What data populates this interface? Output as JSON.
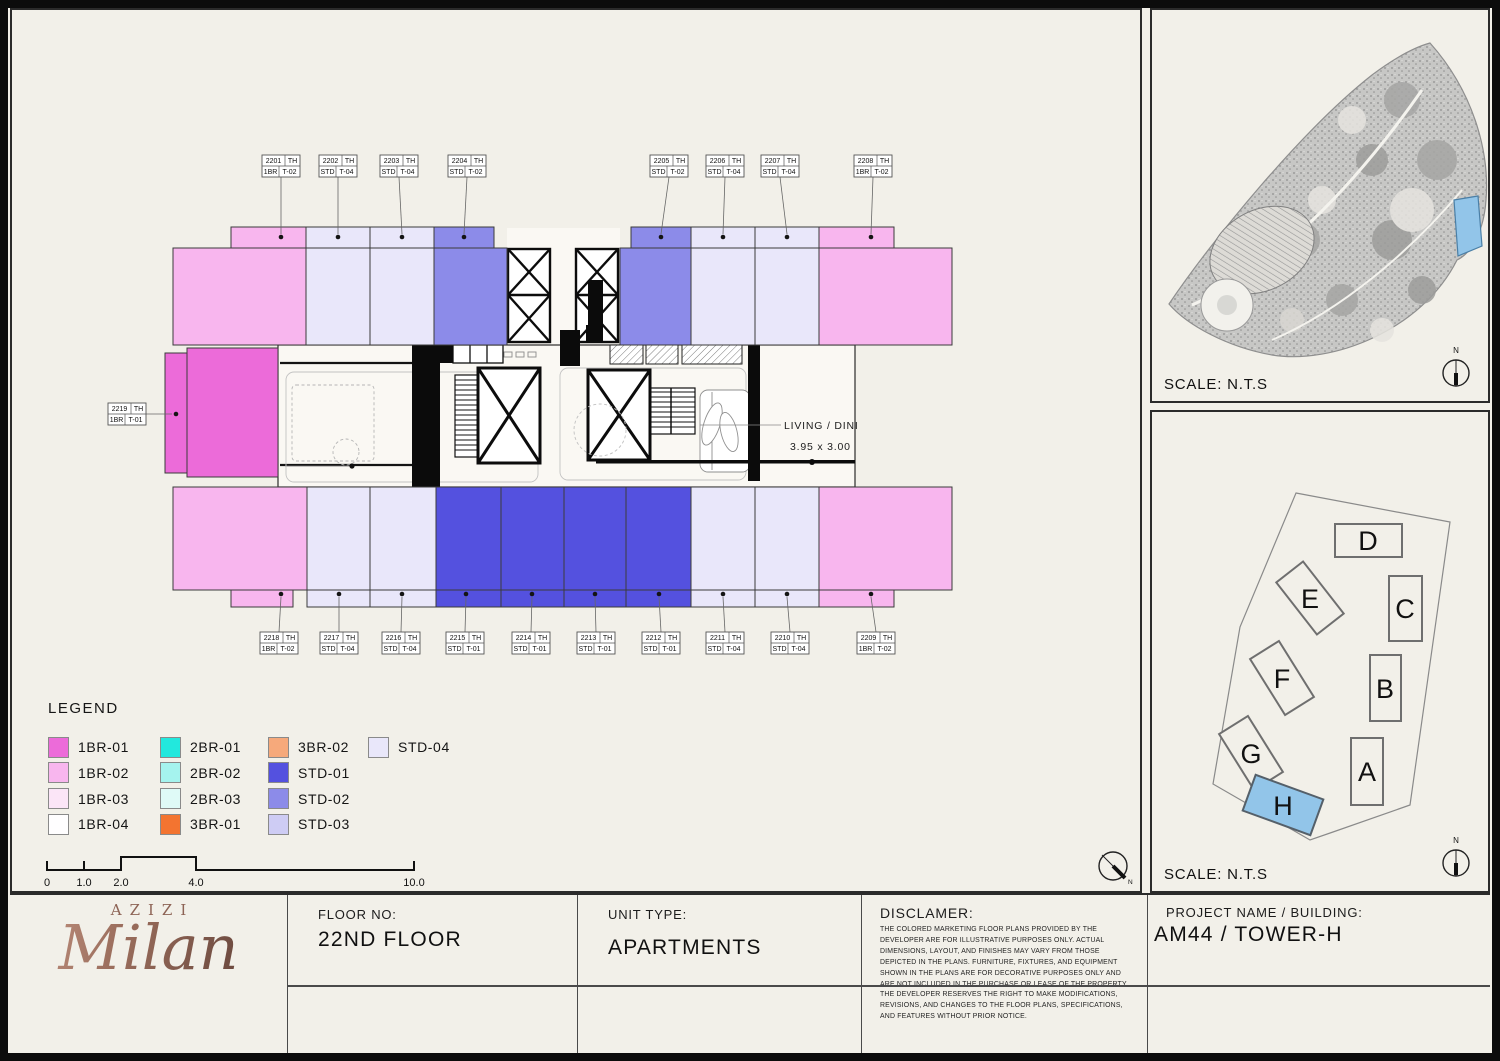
{
  "floor_plan": {
    "units_top": [
      {
        "no": "2201",
        "th": "TH",
        "cat": "1BR",
        "code": "T-02",
        "type": "1BR-02"
      },
      {
        "no": "2202",
        "th": "TH",
        "cat": "STD",
        "code": "T-04",
        "type": "STD-04"
      },
      {
        "no": "2203",
        "th": "TH",
        "cat": "STD",
        "code": "T-04",
        "type": "STD-04"
      },
      {
        "no": "2204",
        "th": "TH",
        "cat": "STD",
        "code": "T-02",
        "type": "STD-02"
      },
      {
        "no": "2205",
        "th": "TH",
        "cat": "STD",
        "code": "T-02",
        "type": "STD-02"
      },
      {
        "no": "2206",
        "th": "TH",
        "cat": "STD",
        "code": "T-04",
        "type": "STD-04"
      },
      {
        "no": "2207",
        "th": "TH",
        "cat": "STD",
        "code": "T-04",
        "type": "STD-04"
      },
      {
        "no": "2208",
        "th": "TH",
        "cat": "1BR",
        "code": "T-02",
        "type": "1BR-02"
      }
    ],
    "units_bottom": [
      {
        "no": "2218",
        "th": "TH",
        "cat": "1BR",
        "code": "T-02",
        "type": "1BR-02"
      },
      {
        "no": "2217",
        "th": "TH",
        "cat": "STD",
        "code": "T-04",
        "type": "STD-04"
      },
      {
        "no": "2216",
        "th": "TH",
        "cat": "STD",
        "code": "T-04",
        "type": "STD-04"
      },
      {
        "no": "2215",
        "th": "TH",
        "cat": "STD",
        "code": "T-01",
        "type": "STD-01"
      },
      {
        "no": "2214",
        "th": "TH",
        "cat": "STD",
        "code": "T-01",
        "type": "STD-01"
      },
      {
        "no": "2213",
        "th": "TH",
        "cat": "STD",
        "code": "T-01",
        "type": "STD-01"
      },
      {
        "no": "2212",
        "th": "TH",
        "cat": "STD",
        "code": "T-01",
        "type": "STD-01"
      },
      {
        "no": "2211",
        "th": "TH",
        "cat": "STD",
        "code": "T-04",
        "type": "STD-04"
      },
      {
        "no": "2210",
        "th": "TH",
        "cat": "STD",
        "code": "T-04",
        "type": "STD-04"
      },
      {
        "no": "2209",
        "th": "TH",
        "cat": "1BR",
        "code": "T-02",
        "type": "1BR-02"
      }
    ],
    "unit_left": {
      "no": "2219",
      "th": "TH",
      "cat": "1BR",
      "code": "T-01",
      "type": "1BR-01"
    },
    "room_label": {
      "name": "LIVING / DINING",
      "dims": "3.95 x 3.00"
    }
  },
  "legend": {
    "title": "LEGEND",
    "items": [
      {
        "label": "1BR-01",
        "color": "#EC6BD9"
      },
      {
        "label": "1BR-02",
        "color": "#F8B6EE"
      },
      {
        "label": "1BR-03",
        "color": "#FBE5F7"
      },
      {
        "label": "1BR-04",
        "color": "#FFFEFF"
      },
      {
        "label": "2BR-01",
        "color": "#22E8DD"
      },
      {
        "label": "2BR-02",
        "color": "#A5F3EE"
      },
      {
        "label": "2BR-03",
        "color": "#DFFAF7"
      },
      {
        "label": "3BR-01",
        "color": "#F37430"
      },
      {
        "label": "3BR-02",
        "color": "#F6A97B"
      },
      {
        "label": "STD-01",
        "color": "#5451DF"
      },
      {
        "label": "STD-02",
        "color": "#8C8BE9"
      },
      {
        "label": "STD-03",
        "color": "#CECCF4"
      },
      {
        "label": "STD-04",
        "color": "#E9E7FA"
      }
    ]
  },
  "scale_bar": {
    "labels": [
      "0",
      "1.0",
      "2.0",
      "4.0",
      "10.0"
    ]
  },
  "site_panel": {
    "scale_label": "SCALE: N.T.S",
    "north_label": "N",
    "highlight_color": "#92C5E9"
  },
  "key_panel": {
    "scale_label": "SCALE: N.T.S",
    "north_label": "N",
    "buildings": [
      "D",
      "E",
      "C",
      "F",
      "B",
      "G",
      "A",
      "H"
    ],
    "highlighted": "H",
    "highlight_color": "#92C5E9"
  },
  "title_block": {
    "logo": {
      "brand": "AZIZI",
      "name": "Milan"
    },
    "floor": {
      "label": "FLOOR NO:",
      "value": "22ND FLOOR"
    },
    "unit_type": {
      "label": "UNIT TYPE:",
      "value": "APARTMENTS"
    },
    "disclaimer": {
      "label": "DISCLAMER:",
      "text": "THE COLORED MARKETING FLOOR PLANS PROVIDED BY THE DEVELOPER ARE FOR ILLUSTRATIVE PURPOSES ONLY. ACTUAL DIMENSIONS, LAYOUT, AND FINISHES MAY VARY FROM THOSE DEPICTED IN THE PLANS. FURNITURE, FIXTURES, AND EQUIPMENT SHOWN IN THE PLANS ARE FOR DECORATIVE PURPOSES ONLY AND ARE NOT INCLUDED IN THE PURCHASE OR LEASE OF THE PROPERTY. THE DEVELOPER RESERVES THE RIGHT TO MAKE MODIFICATIONS, REVISIONS, AND CHANGES TO THE FLOOR PLANS, SPECIFICATIONS, AND FEATURES WITHOUT PRIOR NOTICE."
    },
    "project": {
      "label": "PROJECT NAME / BUILDING:",
      "value": "AM44 / TOWER-H"
    }
  }
}
